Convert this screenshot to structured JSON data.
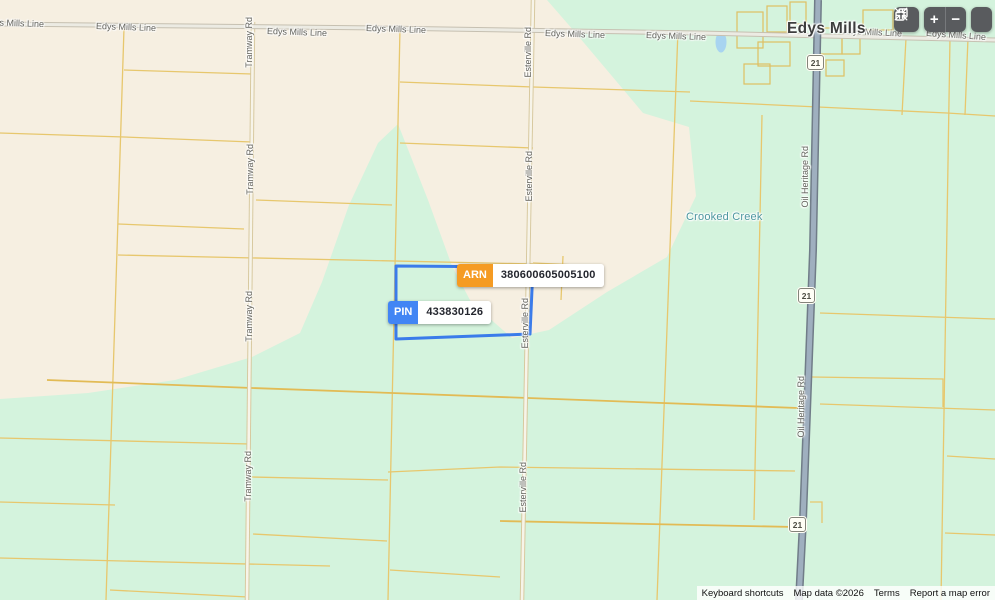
{
  "map": {
    "town_label": "Edys Mills",
    "water_label": "Crooked Creek"
  },
  "parcel": {
    "arn_badge": "ARN",
    "arn_value": "380600605005100",
    "pin_badge": "PIN",
    "pin_value": "433830126"
  },
  "labels": {
    "road_h": [
      {
        "text": "Edys Mills Line",
        "x": -16,
        "y": 19,
        "rot": 2
      },
      {
        "text": "Edys Mills Line",
        "x": 96,
        "y": 23,
        "rot": 2
      },
      {
        "text": "Edys Mills Line",
        "x": 267,
        "y": 28,
        "rot": 2
      },
      {
        "text": "Edys Mills Line",
        "x": 366,
        "y": 25,
        "rot": 2
      },
      {
        "text": "Edys Mills Line",
        "x": 545,
        "y": 30,
        "rot": 2
      },
      {
        "text": "Edys Mills Line",
        "x": 646,
        "y": 32,
        "rot": 2
      },
      {
        "text": "Edys Mills Line",
        "x": 842,
        "y": 28,
        "rot": 3
      },
      {
        "text": "Edys Mills Line",
        "x": 926,
        "y": 31,
        "rot": 4
      }
    ],
    "road_v": [
      {
        "text": "Tramway Rd",
        "x": 245,
        "y": 17
      },
      {
        "text": "Tramway Rd",
        "x": 246,
        "y": 144
      },
      {
        "text": "Tramway Rd",
        "x": 245,
        "y": 291
      },
      {
        "text": "Tramway Rd",
        "x": 244,
        "y": 451
      },
      {
        "text": "Esterville Rd",
        "x": 524,
        "y": 27
      },
      {
        "text": "Esterville Rd",
        "x": 525,
        "y": 151
      },
      {
        "text": "Esterville Rd",
        "x": 521,
        "y": 298
      },
      {
        "text": "Esterville Rd",
        "x": 519,
        "y": 462
      },
      {
        "text": "Oil Heritage Rd",
        "x": 801,
        "y": 146
      },
      {
        "text": "Oil Heritage Rd",
        "x": 797,
        "y": 376
      }
    ]
  },
  "shields": [
    {
      "label": "21",
      "x": 807,
      "y": 55
    },
    {
      "label": "21",
      "x": 798,
      "y": 288
    },
    {
      "label": "21",
      "x": 789,
      "y": 517
    }
  ],
  "controls": {
    "zoom_in": "+",
    "zoom_out": "−",
    "icons": {
      "copy": "copy-icon",
      "fullscreen": "fullscreen-exit-icon"
    }
  },
  "attribution": {
    "keyboard": "Keyboard shortcuts",
    "map_data": "Map data ©2026",
    "terms": "Terms",
    "report": "Report a map error"
  },
  "colors": {
    "land_beige": "#f6efe1",
    "land_green": "#d4f3dd",
    "parcel_line_yellow": "#e7c76d",
    "highlight_blue": "#3a7bea",
    "arn_orange": "#f59b23",
    "pin_blue": "#4285f4",
    "main_road_fill": "#9fafbf",
    "main_road_casing": "#707c88",
    "water_blue": "#a8d4f0"
  }
}
